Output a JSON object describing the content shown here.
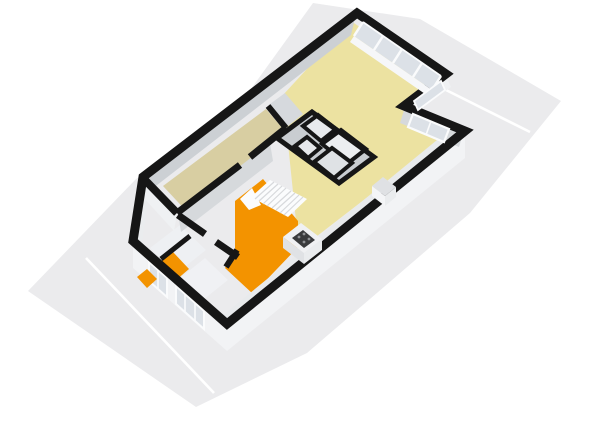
{
  "scene": {
    "type": "3d-floorplan-render",
    "view": "isometric-top",
    "background": "#ffffff"
  },
  "colors": {
    "wall": "#161616",
    "ground": "#ebebed",
    "groundLine": "#ffffff",
    "livingFloor": "#ece2a1",
    "bedroomFloor": "#d8cea2",
    "kitchenFloor": "#f39300",
    "hallFloor": "#d6d9dd",
    "utilityFloor": "#eef0f3",
    "utilityFloor2": "#f0f1f4",
    "bathFloorA": "#e8eaed",
    "bathFloorB": "#eceef0",
    "bathFloorC": "#e6e8eb",
    "bathFloorD": "#dfe2e5",
    "blockMass": "#c9cdd1",
    "innerFaceDark": "#ccd0d4",
    "innerFaceMid": "#d6d9dc",
    "innerFaceLight": "#eff1f3",
    "seWallInner": "#e8eaec",
    "extFace": "#f2f3f5",
    "extFaceSide": "#eaecee",
    "glass": "#dce1e7",
    "frame": "#fafbfc",
    "sill": "#f6f7f9",
    "stairs": "#fbfcfd",
    "stairLine": "#d7d9dc",
    "counter": "#f0f1f3",
    "counterFace": "#e0e2e5",
    "counterSide": "#eaecee",
    "stove": "#3a3b3d",
    "burner": "#8f9194",
    "applianceTop": "#dfe1e4",
    "applianceFace": "#f4f5f7"
  },
  "rooms": [
    {
      "name": "living-room",
      "floor": "#ece2a1"
    },
    {
      "name": "bedroom",
      "floor": "#d8cea2"
    },
    {
      "name": "kitchen",
      "floor": "#f39300"
    },
    {
      "name": "entrance-hall",
      "floor": "#f39300"
    },
    {
      "name": "bathroom-block",
      "floor": "#e8eaed"
    },
    {
      "name": "storage-rooms",
      "floor": "#eef0f3"
    }
  ],
  "objects": [
    "staircase",
    "kitchen-counter",
    "stove",
    "appliance-unit",
    "window-wall",
    "plot-boundary-lines"
  ]
}
